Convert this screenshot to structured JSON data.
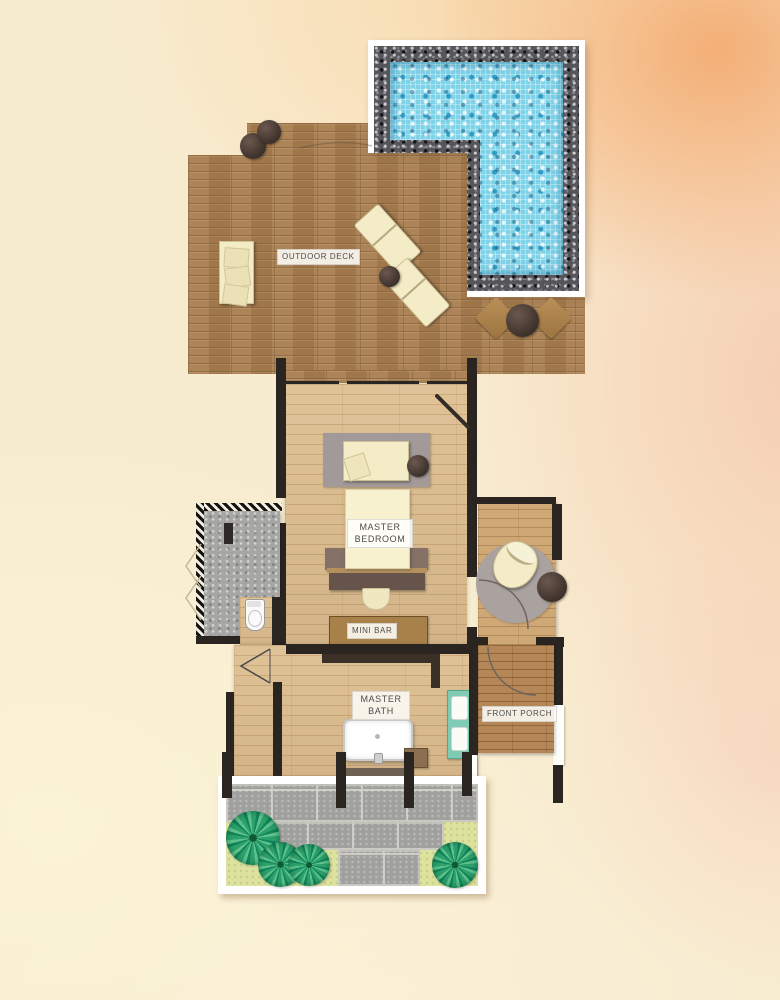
{
  "page": {
    "type": "architectural-floor-plan",
    "view": "top-down villa suite plan with pool"
  },
  "labels": {
    "outdoor_deck": "OUTDOOR DECK",
    "master_bedroom_line1": "MASTER",
    "master_bedroom_line2": "BEDROOM",
    "mini_bar": "MINI BAR",
    "master_bath_line1": "MASTER",
    "master_bath_line2": "BATH",
    "front_porch": "FRONT PORCH"
  },
  "colors": {
    "pool_water": "#7fd3e9",
    "pebble_border": "#55555a",
    "pool_frame": "#ffffff",
    "deck_wood": "#a97e4f",
    "interior_wood": "#debe90",
    "porch_wood": "#b58756",
    "wall": "#2b2521",
    "grass": "#dde29f",
    "tree_green": "#2da06c",
    "paver_gray": "#a0a09e",
    "vanity_teal": "#7fcbb4",
    "rug_gray": "#a39b99",
    "cushion_cream": "#f3ecc6",
    "background_cream": "#f8ecd0",
    "background_peach": "#f4a86c"
  },
  "furniture": [
    "swimming-pool",
    "sun-lounger",
    "sun-lounger",
    "deck-sofa",
    "deck-side-table",
    "deck-stool",
    "deck-stool",
    "floor-cushion",
    "floor-cushion",
    "deck-round-table",
    "daybed",
    "double-bed",
    "headboard-console",
    "pouf",
    "mini-bar-counter",
    "outdoor-shower",
    "toilet",
    "bathtub",
    "double-sink-vanity",
    "bath-bench",
    "porch-armchair",
    "porch-side-table",
    "round-rug",
    "garden-trees"
  ]
}
